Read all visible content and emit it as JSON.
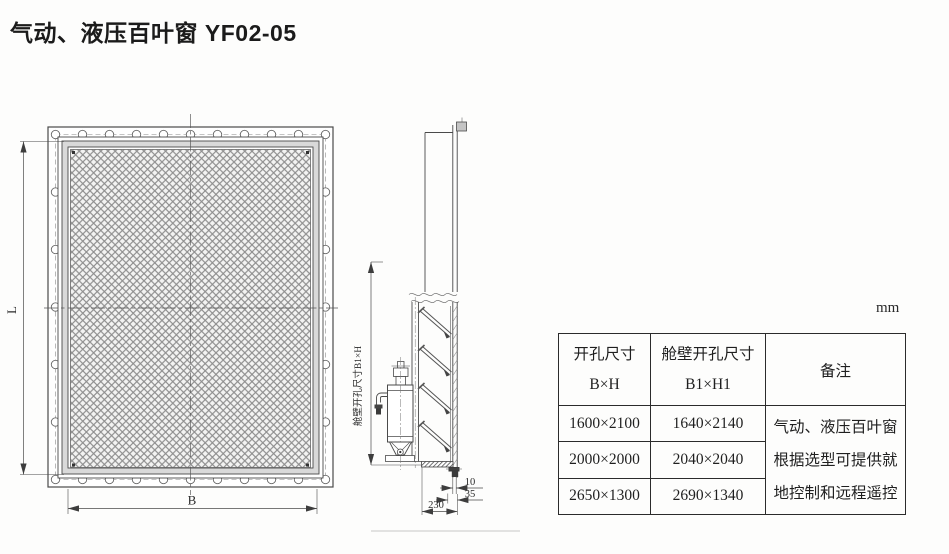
{
  "title": "气动、液压百叶窗 YF02-05",
  "unit_label": "mm",
  "front_view": {
    "height_dim_label": "L",
    "width_dim_label": "B"
  },
  "side_view": {
    "opening_dim_label": "舱壁开孔尺寸B1×H",
    "dim_10": "10",
    "dim_35": "35",
    "dim_230": "230"
  },
  "table": {
    "headers": {
      "opening": {
        "line1": "开孔尺寸",
        "line2": "B×H"
      },
      "bulkhead_opening": {
        "line1": "舱壁开孔尺寸",
        "line2": "B1×H1"
      },
      "remark": "备注"
    },
    "rows": [
      {
        "opening": "1600×2100",
        "bulkhead_opening": "1640×2140"
      },
      {
        "opening": "2000×2000",
        "bulkhead_opening": "2040×2040"
      },
      {
        "opening": "2650×1300",
        "bulkhead_opening": "2690×1340"
      }
    ],
    "remark_lines": [
      "气动、液压百叶窗",
      "根据选型可提供就",
      "地控制和远程遥控"
    ]
  }
}
